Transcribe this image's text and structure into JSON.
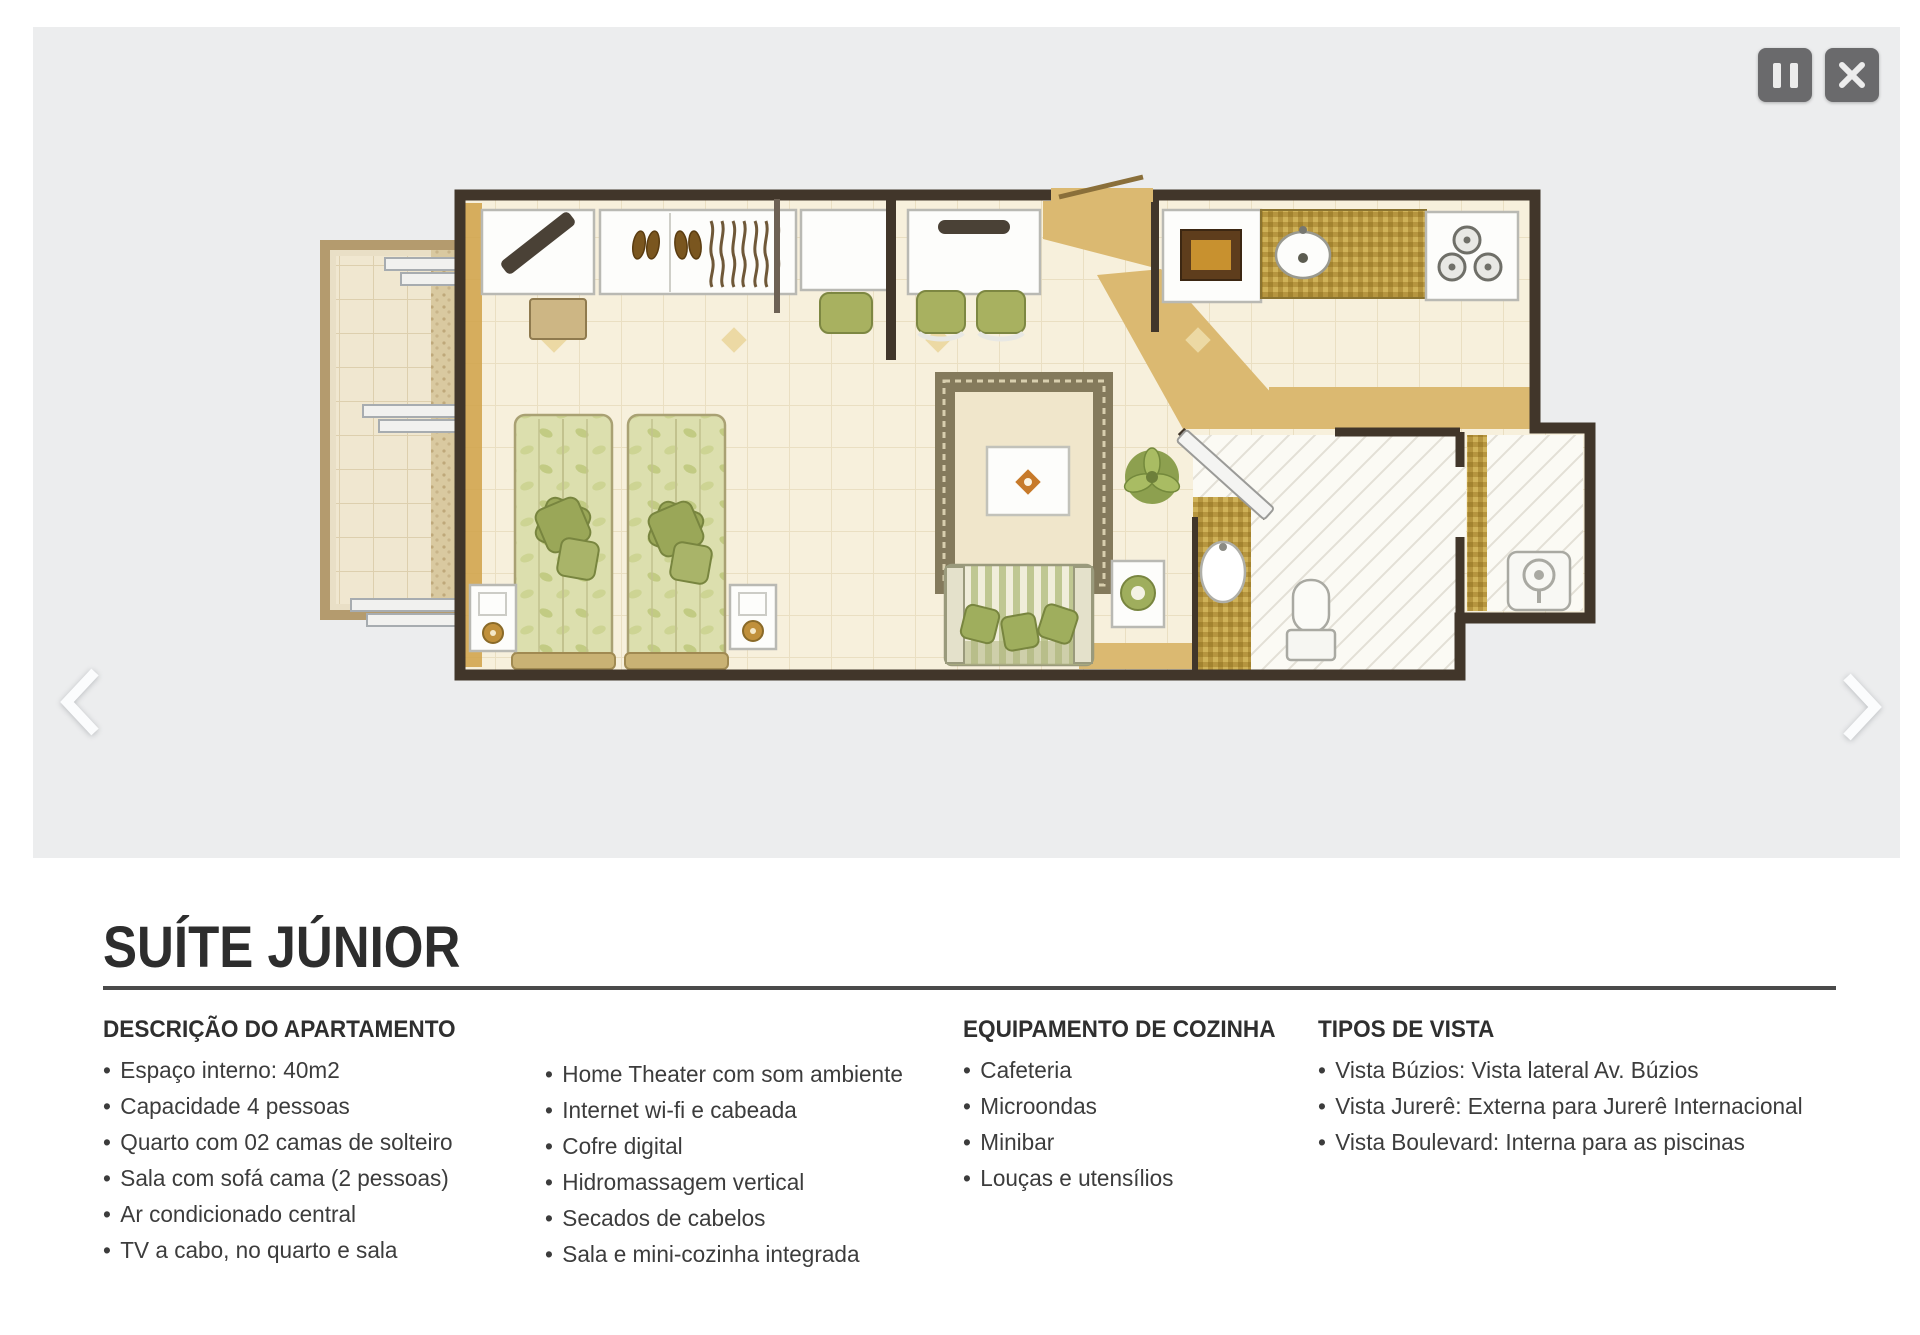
{
  "page": {
    "title": "SUÍTE JÚNIOR"
  },
  "gallery": {
    "type": "floor-plan-slideshow",
    "icons": {
      "pause": "pause-bars",
      "close": "✕",
      "prev": "‹",
      "next": "›"
    }
  },
  "sections": {
    "apartment": {
      "heading": "DESCRIÇÃO DO APARTAMENTO",
      "col1": [
        "Espaço interno: 40m2",
        "Capacidade 4 pessoas",
        "Quarto com 02 camas de solteiro",
        "Sala com sofá cama (2 pessoas)",
        "Ar condicionado central",
        "TV a cabo, no quarto e sala"
      ],
      "col2": [
        "Home Theater com som ambiente",
        "Internet wi-fi e cabeada",
        "Cofre digital",
        "Hidromassagem vertical",
        "Secados de cabelos",
        "Sala e mini-cozinha integrada"
      ]
    },
    "kitchen": {
      "heading": "EQUIPAMENTO DE COZINHA",
      "items": [
        "Cafeteria",
        "Microondas",
        "Minibar",
        "Louças e utensílios"
      ]
    },
    "views": {
      "heading": "TIPOS DE VISTA",
      "items": [
        "Vista Búzios: Vista lateral Av. Búzios",
        "Vista Jurerê: Externa para Jurerê Internacional",
        "Vista Boulevard: Interna para as piscinas"
      ]
    }
  },
  "colors": {
    "gallery_bg": "#ECEDEE",
    "wall": "#41362A",
    "floor": "#F7F0DC",
    "gold_accent": "#DBB971",
    "bed_green": "#DCDFAE",
    "pillow_green": "#9AA758",
    "button_gray": "#6A6A6C",
    "title_text": "#2D2D2D",
    "body_text": "#3C3C3C"
  }
}
